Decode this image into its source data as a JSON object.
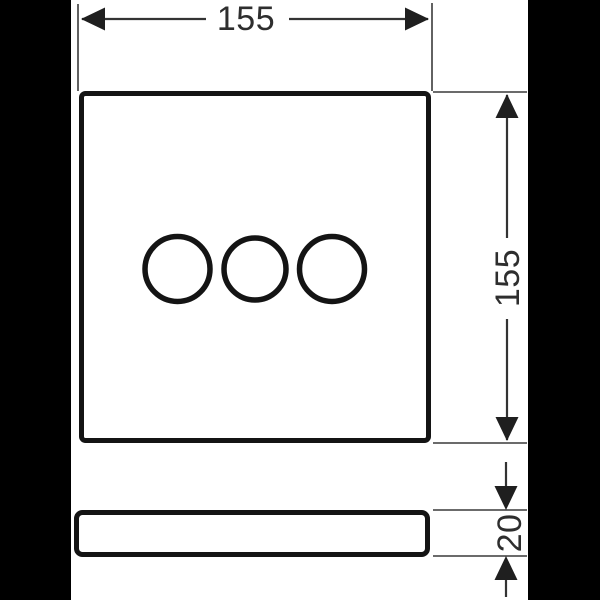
{
  "drawing": {
    "title": "plate-dimension-drawing",
    "views": [
      "front-view",
      "side-view"
    ],
    "front_view": {
      "shape": "rounded-square",
      "handle_circles": 3
    },
    "dimensions": {
      "width": {
        "value": "155",
        "orientation": "horizontal",
        "position": "top"
      },
      "height": {
        "value": "155",
        "orientation": "vertical",
        "position": "right"
      },
      "depth": {
        "value": "20",
        "orientation": "vertical",
        "position": "bottom-right"
      }
    },
    "colors": {
      "canvas": "#ffffff",
      "side_bars": "#000000",
      "object_line": "#141414",
      "dimension_line": "#333333",
      "text": "#2e2e2e"
    }
  }
}
